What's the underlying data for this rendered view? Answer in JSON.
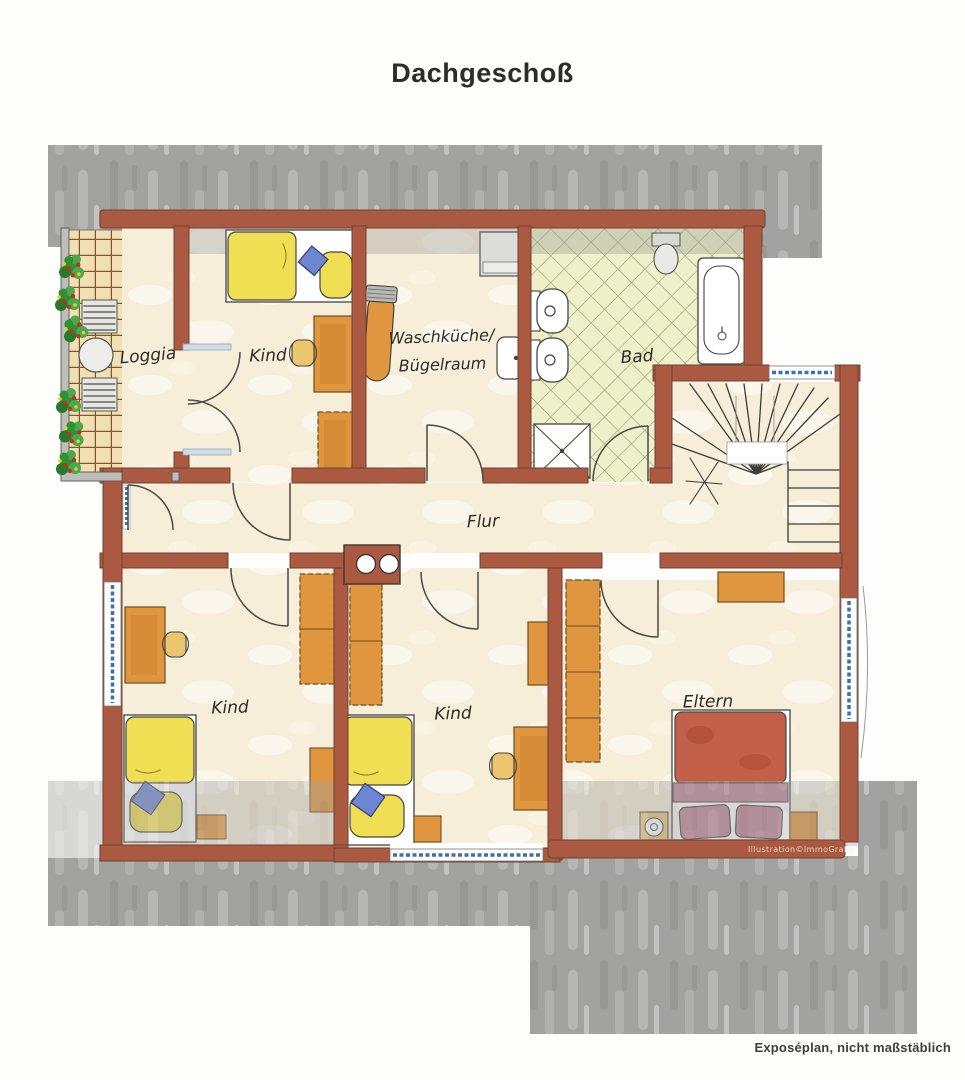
{
  "title": "Dachgeschoß",
  "plan": {
    "rooms": [
      {
        "id": "loggia",
        "label": "Loggia"
      },
      {
        "id": "kind-nw",
        "label": "Kind"
      },
      {
        "id": "waschkueche",
        "label": "Waschküche/Bügelraum",
        "lines": [
          "Waschküche/",
          "Bügelraum"
        ]
      },
      {
        "id": "bad",
        "label": "Bad"
      },
      {
        "id": "flur",
        "label": "Flur"
      },
      {
        "id": "kind-sw",
        "label": "Kind"
      },
      {
        "id": "kind-s",
        "label": "Kind"
      },
      {
        "id": "eltern",
        "label": "Eltern"
      }
    ],
    "fixtures": [
      "plants",
      "round-table",
      "sun-lounger",
      "french-double-door",
      "single-bed",
      "double-bed",
      "desk",
      "chair",
      "wardrobe",
      "ironing-board",
      "washing-machine",
      "sink",
      "toilet",
      "wc",
      "bidet",
      "shower",
      "bathtub",
      "winder-staircase",
      "chimney-flues",
      "nightstand",
      "dresser",
      "window"
    ]
  },
  "caption": "Exposéplan, nicht maßstäblich",
  "watermark": "Illustration©ImmoGrafik",
  "colors": {
    "wall": "#ab5a41",
    "wall_edge": "#6e4333",
    "floor": "#f7eeda",
    "loggia_floor": "#f2dfb4",
    "loggia_grid": "#7d5a2f",
    "bad_tile": "#eef0ca",
    "bad_tile_line": "#999b76",
    "roof": "#a2a2a1",
    "roof_light": "#c6c6c4",
    "roof_dark": "#8b8b8a",
    "knee": "#9d9d98",
    "furn": "#e0963e",
    "furn_dark": "#c77d2b",
    "furn_edge": "#6b4f22",
    "bed_yellow": "#f0df52",
    "pillow_blue": "#6d85d2",
    "bed_red": "#c2604a",
    "mauve": "#bb8196",
    "win_blue": "#3f6fae",
    "win_light": "#8fb8d8",
    "plant_green": "#2e9235",
    "plant_green2": "#4aa84f",
    "plant_red": "#cf2a1b",
    "flower_yellow": "#e5cf2a",
    "ink": "#44443e",
    "text": "#2c2c28"
  }
}
